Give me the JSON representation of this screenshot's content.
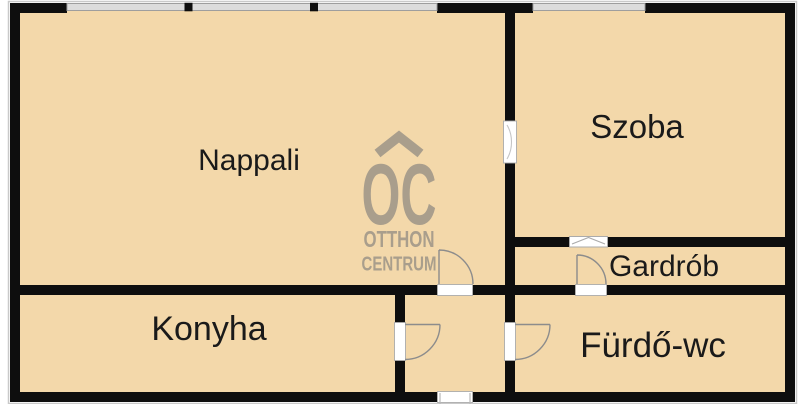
{
  "plan": {
    "type": "apartment-floor-plan",
    "rooms": [
      {
        "id": "nappali",
        "label": "Nappali"
      },
      {
        "id": "szoba",
        "label": "Szoba"
      },
      {
        "id": "gardrob",
        "label": "Gardrób"
      },
      {
        "id": "konyha",
        "label": "Konyha"
      },
      {
        "id": "furdo_wc",
        "label": "Fürdő-wc"
      }
    ],
    "features": {
      "windows": 3,
      "interior_doors": 5,
      "entry_doors": 1
    }
  },
  "watermark": {
    "monogram": "OC",
    "name_line1": "OTTHON",
    "name_line2": "CENTRUM",
    "roof_icon": "chevron-roof"
  },
  "colors": {
    "background": "#ffffff",
    "floor": "#f3d8aa",
    "wall": "#0e0e0e",
    "outline": "#c9c9c9",
    "window_fill": "#dcdcdc",
    "window_edge": "#9e9e9e",
    "opening_fill": "#ffffff",
    "opening_edge": "#ababab",
    "door_arc": "#8c8c8c",
    "watermark": "#a99e8c",
    "label": "#1a1a1a"
  }
}
